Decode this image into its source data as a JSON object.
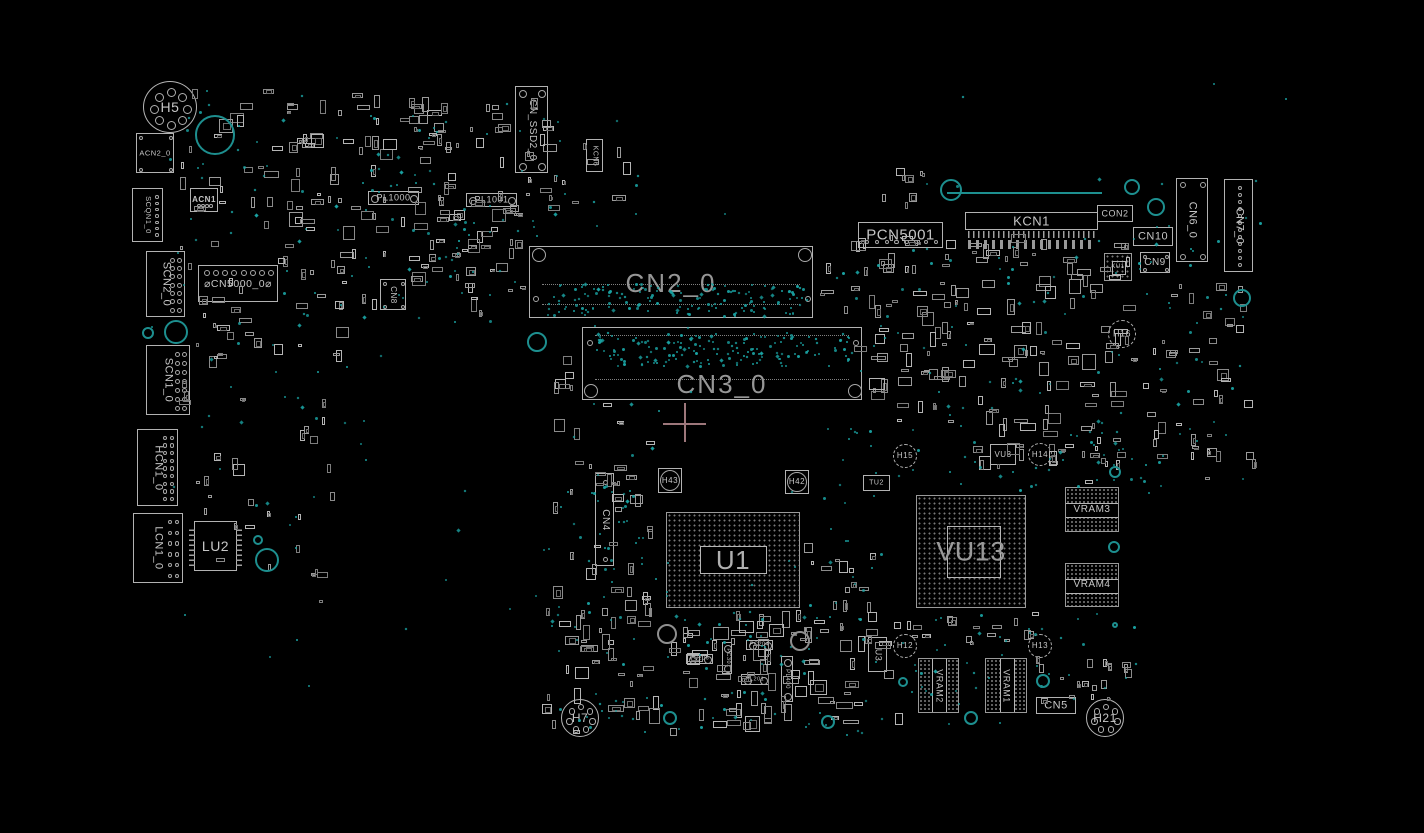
{
  "view": {
    "background": "#000000"
  },
  "colors": {
    "outline": "#b2b2b2",
    "outline_dim": "#7d7d7d",
    "testpoint": "#1aa3a3",
    "teal_ring": "#1d8f8f",
    "gray_ring": "#8f8f8f",
    "big_label": "#969696",
    "small_label": "#c6c6c6",
    "crosshair": "#9d777b"
  },
  "seed": 1337,
  "components": [
    {
      "label": "H5",
      "type": "hole",
      "x": 143,
      "y": 81,
      "w": 54,
      "h": 52,
      "fs": 14,
      "holes": 8,
      "hr": 4.5
    },
    {
      "label": "ACN2_0",
      "type": "conn",
      "x": 136,
      "y": 133,
      "w": 38,
      "h": 40,
      "fs": 7.5,
      "pins": {
        "kind": "corners",
        "r": 2.2
      }
    },
    {
      "label": "SCQN1_0",
      "type": "conn",
      "x": 132,
      "y": 188,
      "w": 31,
      "h": 54,
      "vert": true,
      "fs": 7.5,
      "pins": {
        "kind": "colright",
        "cols": 1,
        "count": 7,
        "r": 1.8
      }
    },
    {
      "label": "ACN1",
      "type": "conn",
      "x": 190,
      "y": 188,
      "w": 28,
      "h": 24,
      "fs": 8,
      "bold": true,
      "pins": {
        "kind": "bottomrow",
        "count": 4,
        "r": 1.8
      }
    },
    {
      "label": "SCN2_0",
      "type": "conn",
      "x": 146,
      "y": 251,
      "w": 39,
      "h": 66,
      "vert": true,
      "fs": 11,
      "pins": {
        "kind": "colright",
        "cols": 2,
        "count": 7,
        "r": 2.5
      }
    },
    {
      "label": "⌀CN5000_0⌀",
      "type": "conn",
      "x": 198,
      "y": 265,
      "w": 80,
      "h": 37,
      "fs": 10.5,
      "pins": {
        "kind": "toprow",
        "count": 8,
        "r": 3
      }
    },
    {
      "label": "SCN1_0",
      "type": "conn",
      "x": 146,
      "y": 345,
      "w": 44,
      "h": 70,
      "vert": true,
      "fs": 11,
      "pins": {
        "kind": "colright",
        "cols": 2,
        "count": 7,
        "r": 2.5
      }
    },
    {
      "label": "HCN1_0",
      "type": "conn",
      "x": 137,
      "y": 429,
      "w": 41,
      "h": 77,
      "vert": true,
      "fs": 11,
      "pins": {
        "kind": "colright",
        "cols": 2,
        "count": 9,
        "r": 2.2
      }
    },
    {
      "label": "LCN1_0",
      "type": "conn",
      "x": 133,
      "y": 513,
      "w": 50,
      "h": 70,
      "vert": true,
      "fs": 11,
      "pins": {
        "kind": "colright",
        "cols": 2,
        "count": 6,
        "r": 2.2
      }
    },
    {
      "label": "LU2",
      "type": "ic",
      "x": 194,
      "y": 521,
      "w": 43,
      "h": 50,
      "fs": 14,
      "pins": {
        "kind": "comb-lr"
      }
    },
    {
      "label": "CN_SSD2_0",
      "type": "conn",
      "x": 515,
      "y": 86,
      "w": 33,
      "h": 87,
      "vert": true,
      "fs": 10,
      "pins": {
        "kind": "corners",
        "r": 4,
        "in": 7
      }
    },
    {
      "label": "KCN6",
      "type": "conn",
      "x": 586,
      "y": 139,
      "w": 17,
      "h": 33,
      "vert": true,
      "fs": 7
    },
    {
      "label": "PL1000",
      "type": "pill",
      "x": 368,
      "y": 191,
      "w": 51,
      "h": 14,
      "fs": 9
    },
    {
      "label": "PL1001",
      "type": "pill",
      "x": 466,
      "y": 193,
      "w": 51,
      "h": 14,
      "fs": 9
    },
    {
      "label": "CN8",
      "type": "conn",
      "x": 380,
      "y": 279,
      "w": 26,
      "h": 31,
      "vert": true,
      "fs": 8,
      "pins": {
        "kind": "corners",
        "r": 2,
        "in": 4
      }
    },
    {
      "label": "CN2_0",
      "type": "bigconn",
      "x": 529,
      "y": 246,
      "w": 284,
      "h": 72,
      "fs": 26,
      "labelY": 36,
      "circles": [
        [
          9,
          8,
          7
        ],
        [
          275,
          8,
          7
        ],
        [
          6,
          52,
          3
        ],
        [
          278,
          52,
          3
        ]
      ],
      "dotlines": [
        37,
        57
      ]
    },
    {
      "label": "CN3_0",
      "type": "bigconn",
      "x": 582,
      "y": 327,
      "w": 280,
      "h": 73,
      "fs": 26,
      "labelY": 56,
      "circles": [
        [
          8,
          63,
          7
        ],
        [
          272,
          63,
          7
        ],
        [
          7,
          15,
          3
        ],
        [
          273,
          15,
          3
        ]
      ],
      "dotlines": [
        7,
        51
      ]
    },
    {
      "label": "PCN5001",
      "type": "conn",
      "x": 858,
      "y": 222,
      "w": 85,
      "h": 26,
      "fs": 15,
      "pins": {
        "kind": "bottomrow",
        "count": 8,
        "r": 2.2
      }
    },
    {
      "label": "KCN1",
      "type": "conn",
      "x": 965,
      "y": 212,
      "w": 133,
      "h": 18,
      "fs": 13,
      "pins": {
        "kind": "comb-b"
      }
    },
    {
      "label": "CON2",
      "type": "conn",
      "x": 1097,
      "y": 205,
      "w": 36,
      "h": 17,
      "fs": 9
    },
    {
      "label": "CN10",
      "type": "conn",
      "x": 1133,
      "y": 227,
      "w": 40,
      "h": 19,
      "fs": 11
    },
    {
      "label": "CN9",
      "type": "conn",
      "x": 1140,
      "y": 252,
      "w": 30,
      "h": 21,
      "fs": 10,
      "pins": {
        "kind": "corners",
        "r": 2,
        "in": 4
      }
    },
    {
      "label": "CN6_0",
      "type": "conn",
      "x": 1176,
      "y": 178,
      "w": 32,
      "h": 84,
      "vert": true,
      "fs": 11,
      "pins": {
        "kind": "corners",
        "r": 3,
        "in": 6
      }
    },
    {
      "label": "CN7_0",
      "type": "conn",
      "x": 1224,
      "y": 179,
      "w": 29,
      "h": 93,
      "vert": true,
      "fs": 11,
      "pins": {
        "kind": "colcenter",
        "count": 12,
        "r": 2
      }
    },
    {
      "label": "KU1",
      "type": "bga",
      "x": 1104,
      "y": 253,
      "w": 28,
      "h": 28,
      "fs": 6,
      "inner": {
        "x": 7,
        "y": 7,
        "w": 14,
        "h": 14,
        "mode": "outline"
      }
    },
    {
      "label": "H16",
      "type": "gear",
      "x": 1108,
      "y": 320,
      "w": 28,
      "h": 28,
      "fs": 9
    },
    {
      "label": "CN4",
      "type": "conn",
      "x": 595,
      "y": 473,
      "w": 19,
      "h": 93,
      "vert": true,
      "fs": 10,
      "pins": {
        "kind": "colcenter",
        "count": 2,
        "r": 2.5
      }
    },
    {
      "label": "H43",
      "type": "ringpad",
      "x": 658,
      "y": 468,
      "w": 24,
      "h": 25,
      "fs": 8
    },
    {
      "label": "H42",
      "type": "ringpad",
      "x": 785,
      "y": 470,
      "w": 24,
      "h": 24,
      "fs": 8
    },
    {
      "label": "U1",
      "type": "bga",
      "x": 666,
      "y": 512,
      "w": 134,
      "h": 96,
      "fs": 26,
      "labelColor": "#b0b0b0",
      "inner": {
        "x": 33,
        "y": 33,
        "w": 67,
        "h": 28,
        "mode": "clear"
      }
    },
    {
      "label": "TU2",
      "type": "conn",
      "x": 863,
      "y": 475,
      "w": 27,
      "h": 16,
      "fs": 7
    },
    {
      "label": "H15",
      "type": "gear",
      "x": 893,
      "y": 444,
      "w": 24,
      "h": 24,
      "fs": 8
    },
    {
      "label": "VU3",
      "type": "conn",
      "x": 990,
      "y": 444,
      "w": 26,
      "h": 21,
      "fs": 8
    },
    {
      "label": "H14",
      "type": "gear",
      "x": 1028,
      "y": 443,
      "w": 24,
      "h": 23,
      "fs": 8
    },
    {
      "label": "VU13",
      "type": "bga",
      "x": 916,
      "y": 495,
      "w": 110,
      "h": 113,
      "fs": 27,
      "labelColor": "#9a9a9a",
      "inner": {
        "x": 30,
        "y": 30,
        "w": 54,
        "h": 52,
        "mode": "outline"
      }
    },
    {
      "label": "VRAM3",
      "type": "ram",
      "x": 1065,
      "y": 487,
      "w": 54,
      "h": 45,
      "fs": 10,
      "band": "h"
    },
    {
      "label": "VRAM4",
      "type": "ram",
      "x": 1065,
      "y": 563,
      "w": 54,
      "h": 44,
      "fs": 10,
      "band": "h"
    },
    {
      "label": "H7",
      "type": "hole",
      "x": 561,
      "y": 699,
      "w": 38,
      "h": 38,
      "fs": 12,
      "holes": 7,
      "hr": 3.2
    },
    {
      "label": "U3",
      "type": "conn",
      "x": 868,
      "y": 637,
      "w": 19,
      "h": 35,
      "vert": true,
      "fs": 9
    },
    {
      "label": "H12",
      "type": "gear",
      "x": 893,
      "y": 634,
      "w": 24,
      "h": 24,
      "fs": 8
    },
    {
      "label": "VRAM2",
      "type": "ram",
      "x": 918,
      "y": 658,
      "w": 41,
      "h": 55,
      "fs": 9,
      "band": "v"
    },
    {
      "label": "VRAM1",
      "type": "ram",
      "x": 985,
      "y": 658,
      "w": 42,
      "h": 55,
      "fs": 9,
      "band": "v"
    },
    {
      "label": "H13",
      "type": "gear",
      "x": 1028,
      "y": 634,
      "w": 24,
      "h": 24,
      "fs": 8
    },
    {
      "label": "CN5",
      "type": "conn",
      "x": 1036,
      "y": 697,
      "w": 40,
      "h": 17,
      "fs": 11
    },
    {
      "label": "H21",
      "type": "hole",
      "x": 1086,
      "y": 699,
      "w": 38,
      "h": 38,
      "fs": 12,
      "holes": 7,
      "hr": 3.2
    },
    {
      "label": "PC206",
      "type": "pill",
      "x": 686,
      "y": 654,
      "w": 27,
      "h": 10,
      "fs": 5.5
    },
    {
      "label": "PC204",
      "type": "pill",
      "x": 746,
      "y": 640,
      "w": 27,
      "h": 10,
      "fs": 5.5
    },
    {
      "label": "PC301",
      "type": "pillv",
      "x": 722,
      "y": 642,
      "w": 10,
      "h": 32,
      "fs": 5.5
    },
    {
      "label": "PL201",
      "type": "pill",
      "x": 741,
      "y": 674,
      "w": 28,
      "h": 11,
      "fs": 5.5
    },
    {
      "label": "PL400",
      "type": "pillv",
      "x": 781,
      "y": 656,
      "w": 12,
      "h": 46,
      "fs": 6
    },
    {
      "label": "",
      "type": "pinrow",
      "x": 968,
      "y": 240,
      "w": 128,
      "h": 9
    }
  ],
  "clutter_regions": [
    {
      "x": 175,
      "y": 85,
      "w": 290,
      "h": 145,
      "count": 70,
      "min": 4,
      "max": 15
    },
    {
      "x": 300,
      "y": 190,
      "w": 235,
      "h": 130,
      "count": 40,
      "min": 4,
      "max": 15
    },
    {
      "x": 175,
      "y": 235,
      "w": 185,
      "h": 175,
      "count": 40,
      "min": 4,
      "max": 14
    },
    {
      "x": 195,
      "y": 415,
      "w": 150,
      "h": 195,
      "count": 25,
      "min": 4,
      "max": 12
    },
    {
      "x": 360,
      "y": 92,
      "w": 275,
      "h": 125,
      "count": 45,
      "min": 4,
      "max": 14
    },
    {
      "x": 410,
      "y": 232,
      "w": 120,
      "h": 85,
      "count": 16,
      "min": 4,
      "max": 12
    },
    {
      "x": 545,
      "y": 398,
      "w": 120,
      "h": 235,
      "count": 38,
      "min": 4,
      "max": 14
    },
    {
      "x": 815,
      "y": 235,
      "w": 145,
      "h": 120,
      "count": 40,
      "min": 4,
      "max": 15
    },
    {
      "x": 955,
      "y": 232,
      "w": 185,
      "h": 245,
      "count": 95,
      "min": 4,
      "max": 16
    },
    {
      "x": 1140,
      "y": 280,
      "w": 118,
      "h": 200,
      "count": 42,
      "min": 4,
      "max": 12
    },
    {
      "x": 1058,
      "y": 428,
      "w": 82,
      "h": 58,
      "count": 10,
      "min": 4,
      "max": 10
    },
    {
      "x": 540,
      "y": 608,
      "w": 365,
      "h": 132,
      "count": 115,
      "min": 4,
      "max": 18
    },
    {
      "x": 905,
      "y": 612,
      "w": 135,
      "h": 38,
      "count": 16,
      "min": 4,
      "max": 10
    },
    {
      "x": 1032,
      "y": 648,
      "w": 100,
      "h": 62,
      "count": 18,
      "min": 4,
      "max": 10
    },
    {
      "x": 800,
      "y": 540,
      "w": 80,
      "h": 95,
      "count": 16,
      "min": 4,
      "max": 12
    },
    {
      "x": 865,
      "y": 330,
      "w": 95,
      "h": 95,
      "count": 26,
      "min": 4,
      "max": 16
    },
    {
      "x": 865,
      "y": 165,
      "w": 90,
      "h": 45,
      "count": 8,
      "min": 4,
      "max": 10
    },
    {
      "x": 545,
      "y": 350,
      "w": 35,
      "h": 45,
      "count": 6,
      "min": 5,
      "max": 12
    }
  ],
  "dot_regions": [
    {
      "x": 546,
      "y": 283,
      "w": 260,
      "h": 32,
      "count": 150
    },
    {
      "x": 596,
      "y": 332,
      "w": 260,
      "h": 34,
      "count": 160
    },
    {
      "x": 175,
      "y": 88,
      "w": 300,
      "h": 240,
      "count": 55
    },
    {
      "x": 360,
      "y": 92,
      "w": 280,
      "h": 140,
      "count": 30
    },
    {
      "x": 300,
      "y": 192,
      "w": 240,
      "h": 135,
      "count": 28
    },
    {
      "x": 200,
      "y": 330,
      "w": 185,
      "h": 200,
      "count": 22
    },
    {
      "x": 542,
      "y": 400,
      "w": 130,
      "h": 235,
      "count": 26
    },
    {
      "x": 588,
      "y": 470,
      "w": 55,
      "h": 110,
      "count": 22
    },
    {
      "x": 818,
      "y": 237,
      "w": 325,
      "h": 240,
      "count": 85
    },
    {
      "x": 955,
      "y": 440,
      "w": 205,
      "h": 58,
      "count": 20
    },
    {
      "x": 1142,
      "y": 200,
      "w": 118,
      "h": 285,
      "count": 30
    },
    {
      "x": 542,
      "y": 610,
      "w": 380,
      "h": 130,
      "count": 70
    },
    {
      "x": 905,
      "y": 612,
      "w": 235,
      "h": 112,
      "count": 35
    },
    {
      "x": 655,
      "y": 560,
      "w": 165,
      "h": 92,
      "count": 18
    },
    {
      "x": 820,
      "y": 470,
      "w": 62,
      "h": 120,
      "count": 14
    },
    {
      "x": 1052,
      "y": 430,
      "w": 92,
      "h": 58,
      "count": 10
    },
    {
      "x": 140,
      "y": 80,
      "w": 1150,
      "h": 660,
      "count": 55
    }
  ],
  "circles": [
    {
      "x": 215,
      "y": 135,
      "r": 20,
      "c": "t"
    },
    {
      "x": 176,
      "y": 332,
      "r": 12,
      "c": "t"
    },
    {
      "x": 148,
      "y": 333,
      "r": 6,
      "c": "t"
    },
    {
      "x": 258,
      "y": 540,
      "r": 5,
      "c": "t"
    },
    {
      "x": 267,
      "y": 560,
      "r": 12,
      "c": "t"
    },
    {
      "x": 537,
      "y": 342,
      "r": 10,
      "c": "t"
    },
    {
      "x": 951,
      "y": 190,
      "r": 11,
      "c": "t"
    },
    {
      "x": 1132,
      "y": 187,
      "r": 8,
      "c": "t"
    },
    {
      "x": 1156,
      "y": 207,
      "r": 9,
      "c": "t"
    },
    {
      "x": 1242,
      "y": 298,
      "r": 9,
      "c": "t"
    },
    {
      "x": 1115,
      "y": 472,
      "r": 6,
      "c": "t"
    },
    {
      "x": 1114,
      "y": 547,
      "r": 6,
      "c": "t"
    },
    {
      "x": 903,
      "y": 682,
      "r": 5,
      "c": "t"
    },
    {
      "x": 1043,
      "y": 681,
      "r": 7,
      "c": "t"
    },
    {
      "x": 971,
      "y": 718,
      "r": 7,
      "c": "t"
    },
    {
      "x": 670,
      "y": 718,
      "r": 7,
      "c": "t"
    },
    {
      "x": 828,
      "y": 722,
      "r": 7,
      "c": "t"
    },
    {
      "x": 1115,
      "y": 625,
      "r": 3,
      "c": "t"
    },
    {
      "x": 667,
      "y": 634,
      "r": 10,
      "c": "w"
    },
    {
      "x": 800,
      "y": 641,
      "r": 10,
      "c": "w"
    }
  ],
  "lines": [
    {
      "x": 947,
      "y": 192,
      "len": 155,
      "dir": "h",
      "color": "#1d8f8f"
    }
  ],
  "crosshair": {
    "x": 684,
    "y": 423,
    "left": 21,
    "right": 22,
    "up": 20,
    "down": 19
  }
}
